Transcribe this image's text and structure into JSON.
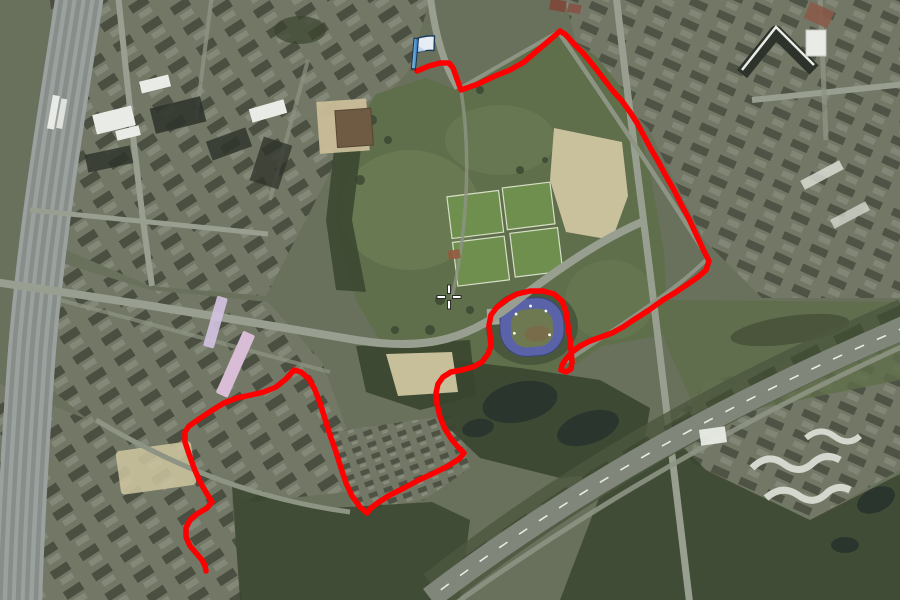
{
  "app": {
    "type": "satellite-map-view",
    "description": "Aerial satellite map with recorded GPS route overlay, start flag marker and center crosshair"
  },
  "view": {
    "width": 900,
    "height": 600
  },
  "palette": {
    "land_base": "#69705b",
    "urban": "#737866",
    "park_grass": "#5f6e4b",
    "park_light": "#74855a",
    "trees_dark": "#3a452f",
    "water": "#2a352e",
    "sand": "#cfc5a0",
    "field_green": "#6f8f4f",
    "field_line": "#d7dec6",
    "road": "#999f90",
    "road_minor": "#8d9483",
    "highway": "#80867a",
    "lane_marking": "#e8eae4",
    "railway": "#9ba19e",
    "railway_dark": "#878d88",
    "building_dark": "#2d322a",
    "building_white": "#e9ebe6",
    "building_pink": "#d9bcd6",
    "building_brown": "#6f5a44",
    "plaza_beige": "#c9bd99",
    "stadium_track": "#5a63a8",
    "stadium_infield": "#6f7951",
    "crosshair_fill": "#ffffff",
    "crosshair_outline": "#1f1f1f"
  },
  "marker": {
    "name": "route-start-flag",
    "x": 413,
    "y": 68,
    "pole_color_light": "#8ec6ee",
    "pole_color_dark": "#2a6db5",
    "banner_color": "#e6edf5",
    "outline_color": "#1d3d5c"
  },
  "crosshair": {
    "x": 449,
    "y": 297
  },
  "route": {
    "color": "#fe0000",
    "width": 5.5,
    "points": [
      [
        417,
        71
      ],
      [
        429,
        66
      ],
      [
        440,
        63
      ],
      [
        449,
        63
      ],
      [
        453,
        68
      ],
      [
        457,
        79
      ],
      [
        461,
        90
      ],
      [
        478,
        84
      ],
      [
        495,
        76
      ],
      [
        510,
        70
      ],
      [
        524,
        62
      ],
      [
        538,
        50
      ],
      [
        551,
        39
      ],
      [
        560,
        31
      ],
      [
        566,
        35
      ],
      [
        574,
        44
      ],
      [
        583,
        53
      ],
      [
        593,
        65
      ],
      [
        603,
        78
      ],
      [
        613,
        91
      ],
      [
        622,
        101
      ],
      [
        630,
        112
      ],
      [
        637,
        123
      ],
      [
        644,
        136
      ],
      [
        651,
        149
      ],
      [
        658,
        161
      ],
      [
        666,
        176
      ],
      [
        674,
        190
      ],
      [
        681,
        204
      ],
      [
        689,
        219
      ],
      [
        696,
        234
      ],
      [
        703,
        249
      ],
      [
        709,
        261
      ],
      [
        706,
        270
      ],
      [
        698,
        277
      ],
      [
        688,
        284
      ],
      [
        676,
        292
      ],
      [
        663,
        300
      ],
      [
        649,
        310
      ],
      [
        635,
        319
      ],
      [
        623,
        327
      ],
      [
        612,
        333
      ],
      [
        601,
        337
      ],
      [
        590,
        341
      ],
      [
        580,
        346
      ],
      [
        572,
        352
      ],
      [
        566,
        359
      ],
      [
        562,
        365
      ],
      [
        561,
        370
      ],
      [
        566,
        372
      ],
      [
        571,
        369
      ],
      [
        572,
        362
      ],
      [
        571,
        350
      ],
      [
        570,
        340
      ],
      [
        568,
        326
      ],
      [
        566,
        312
      ],
      [
        562,
        301
      ],
      [
        554,
        294
      ],
      [
        543,
        291
      ],
      [
        530,
        291
      ],
      [
        517,
        294
      ],
      [
        506,
        300
      ],
      [
        497,
        307
      ],
      [
        491,
        315
      ],
      [
        489,
        325
      ],
      [
        490,
        336
      ],
      [
        491,
        346
      ],
      [
        488,
        354
      ],
      [
        482,
        362
      ],
      [
        473,
        367
      ],
      [
        462,
        370
      ],
      [
        451,
        372
      ],
      [
        443,
        377
      ],
      [
        438,
        384
      ],
      [
        436,
        393
      ],
      [
        437,
        404
      ],
      [
        440,
        417
      ],
      [
        445,
        429
      ],
      [
        452,
        440
      ],
      [
        459,
        448
      ],
      [
        464,
        453
      ],
      [
        459,
        459
      ],
      [
        448,
        466
      ],
      [
        434,
        473
      ],
      [
        419,
        480
      ],
      [
        404,
        488
      ],
      [
        390,
        495
      ],
      [
        379,
        502
      ],
      [
        371,
        508
      ],
      [
        367,
        513
      ],
      [
        360,
        507
      ],
      [
        352,
        496
      ],
      [
        346,
        483
      ],
      [
        341,
        468
      ],
      [
        336,
        452
      ],
      [
        330,
        435
      ],
      [
        325,
        419
      ],
      [
        320,
        403
      ],
      [
        315,
        390
      ],
      [
        309,
        379
      ],
      [
        301,
        372
      ],
      [
        294,
        370
      ],
      [
        286,
        379
      ],
      [
        276,
        387
      ],
      [
        264,
        392
      ],
      [
        251,
        395
      ],
      [
        237,
        398
      ],
      [
        224,
        403
      ],
      [
        211,
        411
      ],
      [
        199,
        419
      ],
      [
        189,
        426
      ],
      [
        185,
        432
      ],
      [
        185,
        442
      ],
      [
        189,
        454
      ],
      [
        194,
        468
      ],
      [
        200,
        482
      ],
      [
        207,
        494
      ],
      [
        212,
        502
      ],
      [
        207,
        508
      ],
      [
        197,
        514
      ],
      [
        190,
        520
      ],
      [
        186,
        528
      ],
      [
        186,
        537
      ],
      [
        190,
        546
      ],
      [
        196,
        553
      ],
      [
        202,
        560
      ],
      [
        205,
        566
      ],
      [
        206,
        571
      ]
    ]
  },
  "features": {
    "stadium": {
      "label": "athletics-stadium",
      "cx": 532,
      "cy": 327
    },
    "sports_fields": {
      "label": "sports-fields",
      "count": 4
    },
    "railway": {
      "label": "railway-yard-left-edge"
    },
    "highway": {
      "label": "diagonal-highway-bottom-right"
    },
    "ponds": {
      "label": "park-ponds"
    }
  }
}
